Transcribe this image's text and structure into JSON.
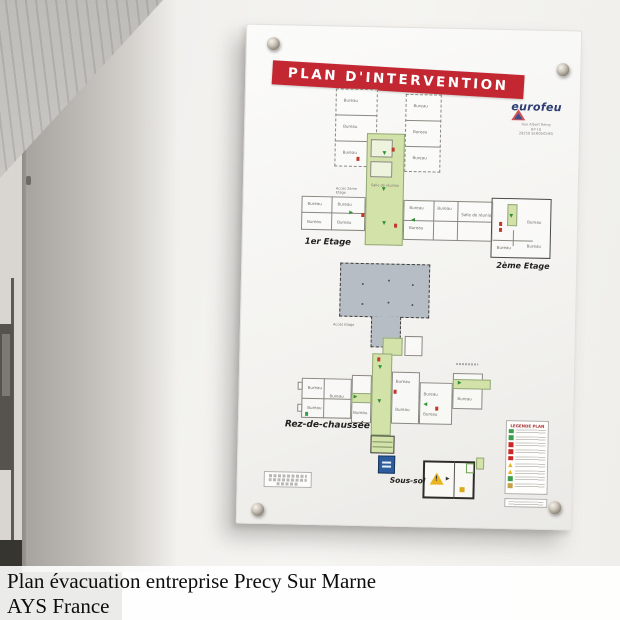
{
  "page": {
    "caption_line1": "Plan évacuation entreprise Precy Sur Marne",
    "caption_line2": "AYS France"
  },
  "panel": {
    "title": "PLAN D'INTERVENTION",
    "brand": {
      "name": "eurofeu",
      "address_lines": [
        "Rue Albert Rémy",
        "BP 10",
        "28250 SENONCHES"
      ]
    },
    "floors": {
      "first_label": "1er Etage",
      "second_label": "2ème Etage",
      "ground_label": "Rez-de-chaussée",
      "basement_label": "Sous-sol"
    },
    "labels": {
      "room": "Bureau",
      "meeting_room": "Salle de réunion",
      "access_floor": "Accès Etage",
      "access_second": "Accès 2ème Etage"
    },
    "legend": {
      "title": "LEGENDE PLAN",
      "icon_colors": [
        "#3a9e4c",
        "#3a9e4c",
        "#cc2727",
        "#cc2727",
        "#cc2727",
        "#e5b422",
        "#e5b422",
        "#3a9e4c",
        "#c2a14b"
      ]
    },
    "colors": {
      "banner_red": "#c32832",
      "corridor_green": "#d3e2a9",
      "warehouse_grey": "#b7bdc4",
      "sign_blue": "#2d5c9e"
    }
  }
}
